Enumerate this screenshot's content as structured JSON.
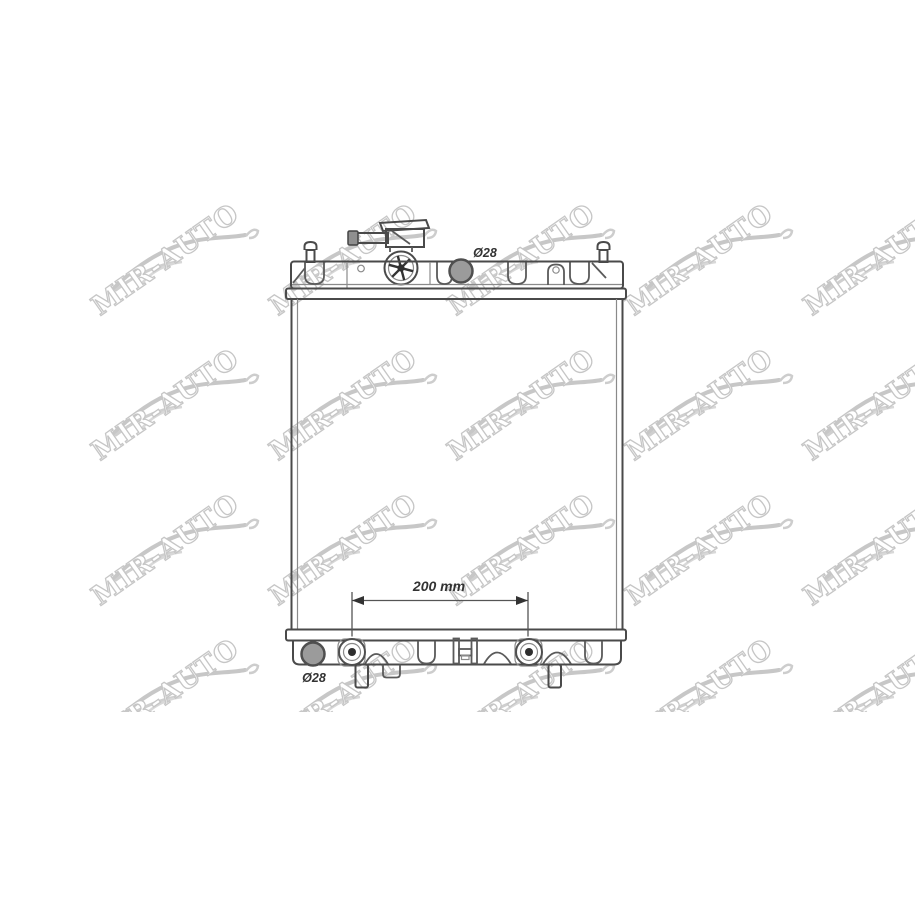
{
  "watermark": {
    "text": "MIR-AUTO"
  },
  "drawing": {
    "labels": {
      "top_port_diameter": "Ø28",
      "bottom_port_diameter": "Ø28",
      "mount_spacing": "200 mm"
    }
  },
  "colors": {
    "background": "#ffffff",
    "line": "#4a4a4a",
    "line_light": "#8a8a8a",
    "port_fill": "#9b9b9b",
    "watermark_gray": "#c6c6c6"
  }
}
